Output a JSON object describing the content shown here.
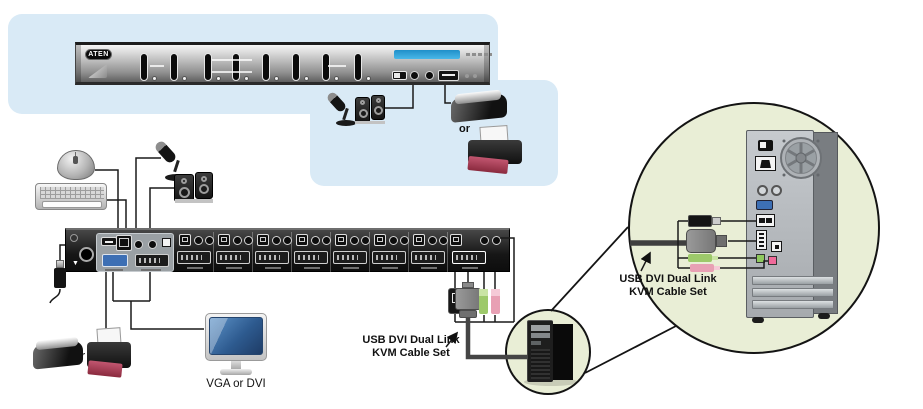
{
  "labels": {
    "brand": "ATEN",
    "kvm_cable": {
      "line1": "USB DVI Dual Link",
      "line2": "KVM Cable Set"
    },
    "monitor": "VGA or DVI",
    "or_front": "or",
    "or_console": "or"
  },
  "colors": {
    "background_blue": "#d9eaf6",
    "callout_green": "#e9eed6",
    "panel_dark": "#161616",
    "panel_silver": "#b9b9b9",
    "lcd_blue": "#2d9fd8",
    "audio_green": "#9dc96a",
    "audio_pink": "#e8a0b4",
    "monitor_blue": "#2e5b90",
    "printer_red": "#a03046"
  }
}
